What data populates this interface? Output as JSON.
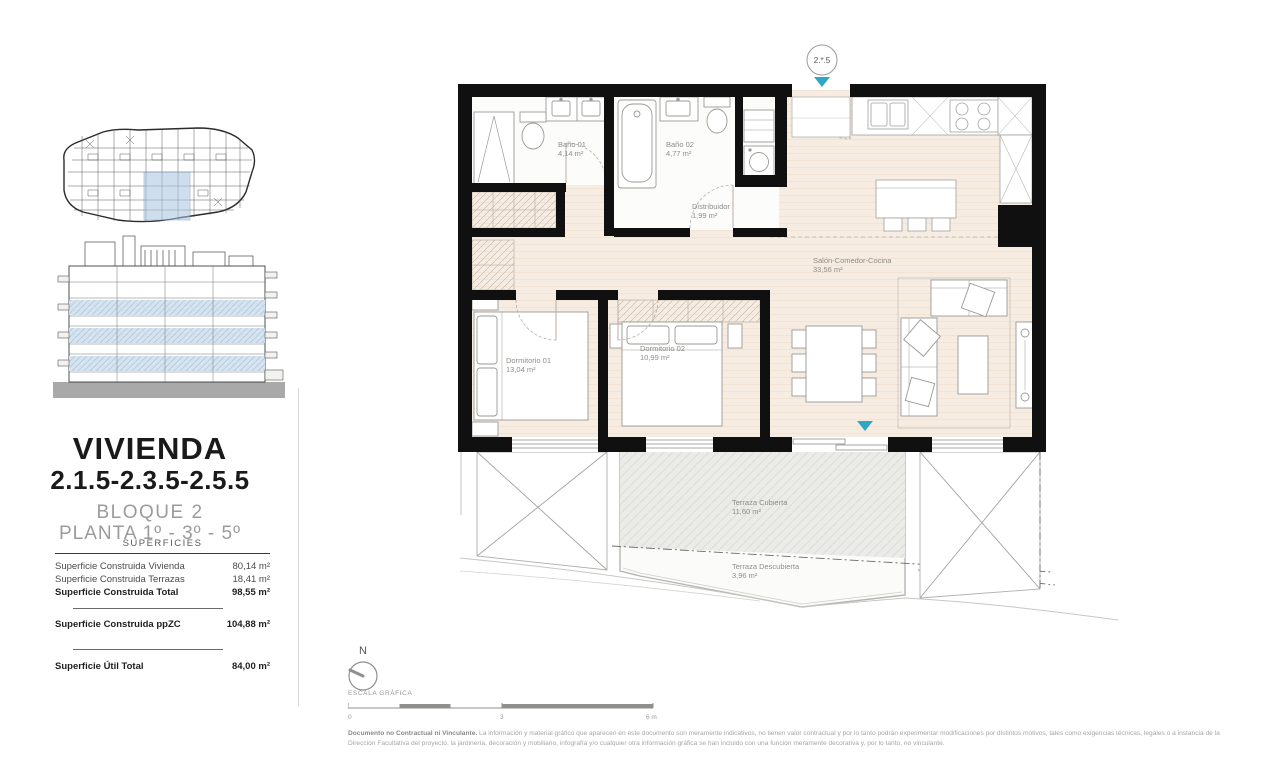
{
  "panel": {
    "title": "VIVIENDA",
    "subtitle": "2.1.5-2.3.5-2.5.5",
    "block": "BLOQUE 2",
    "floor": "PLANTA 1º - 3º - 5º",
    "table": {
      "header": "SUPERFICIES",
      "rows": [
        {
          "label": "Superficie Construida Vivienda",
          "value": "80,14 m²"
        },
        {
          "label": "Superficie Construida Terrazas",
          "value": "18,41 m²"
        },
        {
          "label": "Superficie Construida Total",
          "value": "98,55 m²"
        },
        {
          "label": "Superficie Construida ppZC",
          "value": "104,88 m²"
        },
        {
          "label": "Superficie Útil Total",
          "value": "84,00 m²"
        }
      ]
    }
  },
  "plan": {
    "unit_marker": "2.*.5",
    "marker_color": "#2ea7c6",
    "rooms": {
      "bano1": {
        "name": "Baño 01",
        "area": "4,14 m²"
      },
      "bano2": {
        "name": "Baño 02",
        "area": "4,77 m²"
      },
      "distribuidor": {
        "name": "Distribuidor",
        "area": "1,99 m²"
      },
      "dorm1": {
        "name": "Dormitorio 01",
        "area": "13,04 m²"
      },
      "dorm2": {
        "name": "Dormitorio 02",
        "area": "10,99 m²"
      },
      "salon": {
        "name": "Salón-Comedor-Cocina",
        "area": "33,56 m²"
      },
      "terraza_cubierta": {
        "name": "Terraza Cubierta",
        "area": "11,60 m²"
      },
      "terraza_descubierta": {
        "name": "Terraza Descubierta",
        "area": "3,96 m²"
      }
    }
  },
  "footer": {
    "north_label": "N",
    "scale_label": "ESCALA GRÁFICA",
    "scale_ticks": [
      "0",
      "3",
      "6 m"
    ],
    "disclaimer_bold": "Documento no Contractual ni Vinculante.",
    "disclaimer_text": " La información y material gráfico que aparecen en este documento son meramente indicativos, no tienen valor contractual y por lo tanto podrán experimentar modificaciones por distintos motivos, tales como exigencias técnicas, legales o a instancia de la Dirección Facultativa del proyecto, la jardinería, decoración y mobiliario, infografía y/o cualquier otra información gráfica se han incluido con una función meramente decorativa y, por lo tanto, no vinculante."
  }
}
